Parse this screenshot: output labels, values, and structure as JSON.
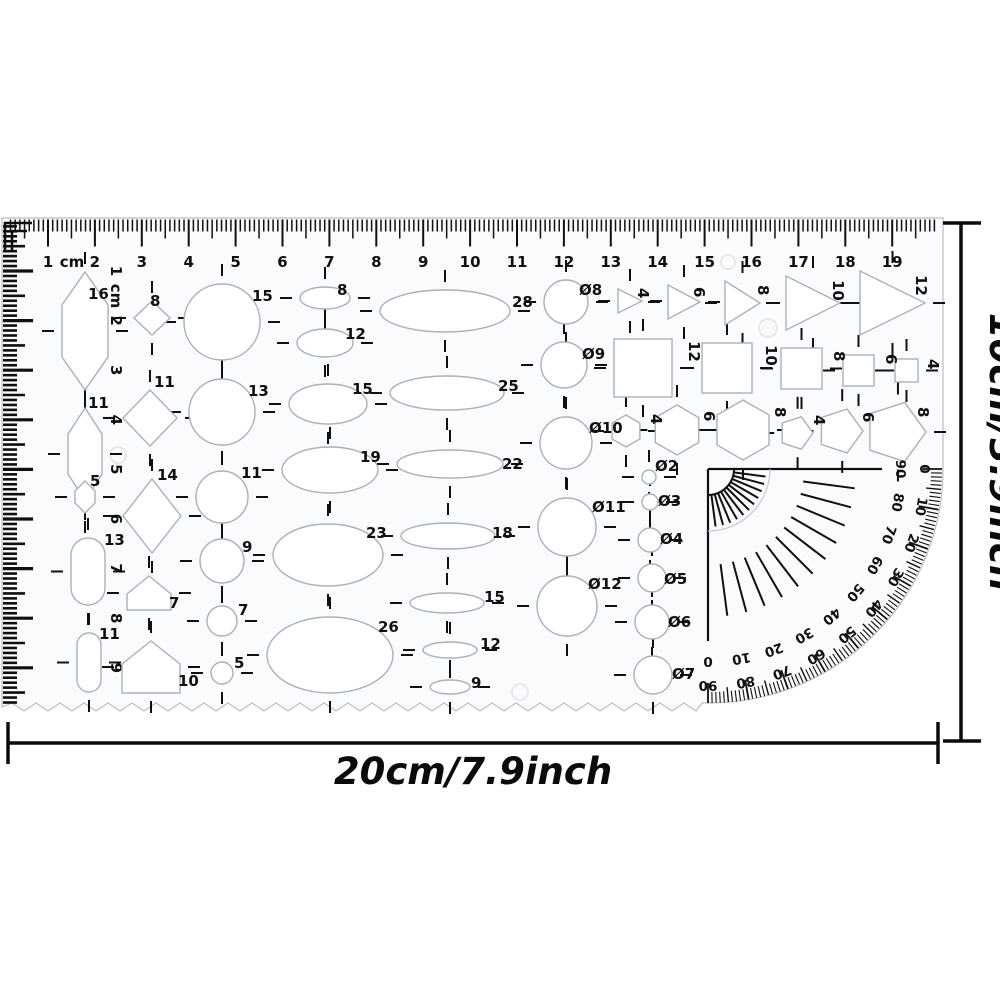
{
  "product": {
    "background": "#ffffff",
    "template_fill": "#fafbfc",
    "ink": "#101010",
    "cutout_edge": "#a9b1bb",
    "annotation": "#0b0b0b"
  },
  "top_ruler": {
    "unit": "cm",
    "numbers": [
      "1",
      "2",
      "3",
      "4",
      "5",
      "6",
      "7",
      "8",
      "9",
      "10",
      "11",
      "12",
      "13",
      "14",
      "15",
      "16",
      "17",
      "18",
      "19"
    ]
  },
  "left_ruler": {
    "unit": "cm",
    "numbers": [
      "1",
      "2",
      "3",
      "4",
      "5",
      "6",
      "7",
      "8",
      "9"
    ]
  },
  "cutouts": {
    "hexagons": [
      "16",
      "11",
      "5"
    ],
    "stadiums": [
      "13",
      "11"
    ],
    "diamonds": [
      "8",
      "11",
      "14"
    ],
    "houses": [
      "7",
      "10"
    ],
    "circles": [
      "15",
      "13",
      "11",
      "9",
      "7",
      "5"
    ],
    "ellipses_inner": [
      "8",
      "12",
      "15",
      "19",
      "23",
      "26"
    ],
    "ellipses_outer": [
      "28",
      "25",
      "22",
      "18",
      "15",
      "12",
      "9"
    ],
    "diameter_circles": [
      "Ø8",
      "Ø9",
      "Ø10",
      "Ø11",
      "Ø12"
    ],
    "small_diameter_circles": [
      "Ø2",
      "Ø3",
      "Ø4",
      "Ø5",
      "Ø6",
      "Ø7"
    ],
    "triangles": [
      "4",
      "6",
      "8",
      "10",
      "12"
    ],
    "squares": [
      "12",
      "10",
      "8",
      "6",
      "4"
    ],
    "hexagons_row": [
      "4",
      "6",
      "8"
    ],
    "pentagons_row": [
      "4",
      "6",
      "8"
    ]
  },
  "protractor": {
    "inner_scale": [
      "90",
      "80",
      "70",
      "60",
      "50",
      "40",
      "30",
      "20",
      "10",
      "0"
    ],
    "outer_scale": [
      "0",
      "10",
      "20",
      "30",
      "40",
      "50",
      "60",
      "70",
      "80",
      "90"
    ]
  },
  "dimensions": {
    "width_label": "20cm/7.9inch",
    "height_label": "10cm/3.9inch"
  }
}
